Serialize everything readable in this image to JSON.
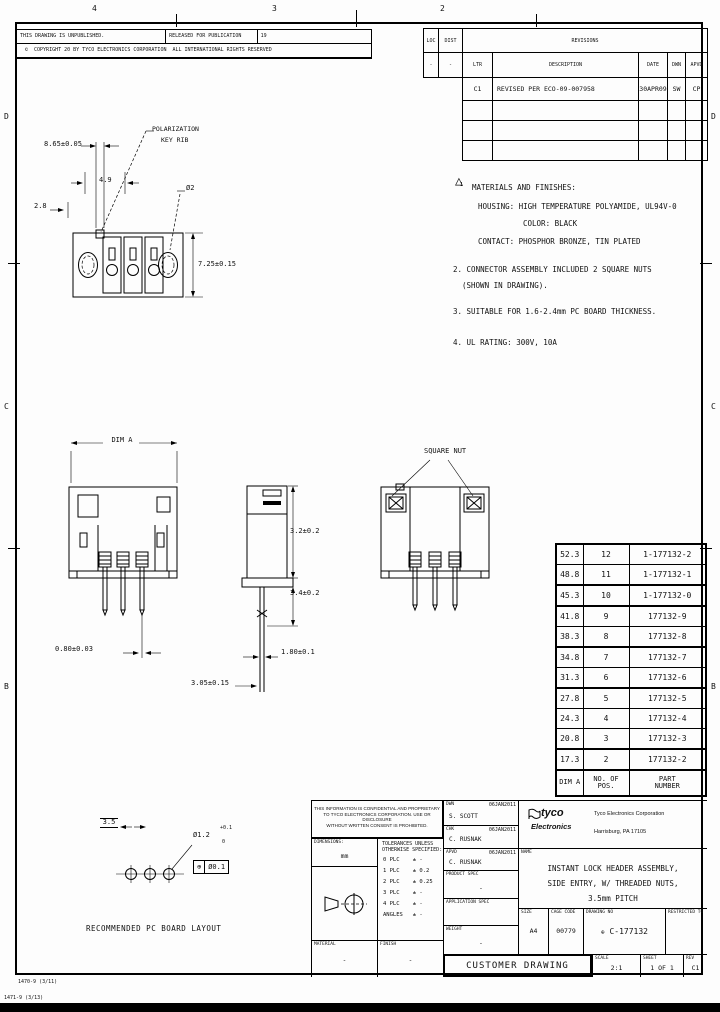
{
  "sheet": {
    "zones_top": [
      "4",
      "3",
      "2"
    ],
    "zones_left": [
      "D",
      "C",
      "B"
    ],
    "zones_right": [
      "D",
      "C",
      "B"
    ],
    "form_no_inner": "1470-9 (3/11)",
    "form_no_outer": "1471-9 (3/13)"
  },
  "header": {
    "unpublished": "THIS DRAWING IS UNPUBLISHED.",
    "released": "RELEASED FOR PUBLICATION",
    "released_date": "19",
    "copyright_symbol": "©",
    "copyright_text": "COPYRIGHT 20      BY TYCO ELECTRONICS CORPORATION",
    "rights_text": "ALL INTERNATIONAL RIGHTS RESERVED"
  },
  "revisions": {
    "loc_label": "LOC",
    "dist_label": "DIST",
    "loc_value": "-",
    "dist_value": "-",
    "title": "REVISIONS",
    "col_ltr": "LTR",
    "col_description": "DESCRIPTION",
    "col_date": "DATE",
    "col_dwn": "DWN",
    "col_apvd": "APVD",
    "rows": [
      {
        "ltr": "C1",
        "description": "REVISED PER ECO-09-007958",
        "date": "30APR09",
        "dwn": "SW",
        "apvd": "CP"
      }
    ]
  },
  "notes": {
    "flag1": "△",
    "flag1_num": "1",
    "n1": "MATERIALS AND FINISHES:",
    "n1a": "HOUSING: HIGH TEMPERATURE POLYAMIDE, UL94V-0",
    "n1b": "COLOR: BLACK",
    "n1c": "CONTACT: PHOSPHOR BRONZE, TIN PLATED",
    "n2": "2. CONNECTOR ASSEMBLY INCLUDED 2 SQUARE NUTS",
    "n2a": "(SHOWN IN DRAWING).",
    "n3": "3. SUITABLE FOR 1.6-2.4mm PC BOARD THICKNESS.",
    "n4": "4. UL RATING: 300V, 10A"
  },
  "part_table": {
    "headers": [
      "DIM A",
      "NO. OF\nPOS.",
      "PART\nNUMBER"
    ],
    "rows": [
      [
        "52.3",
        "12",
        "1-177132-2"
      ],
      [
        "48.8",
        "11",
        "1-177132-1"
      ],
      [
        "45.3",
        "10",
        "1-177132-0"
      ],
      [
        "41.8",
        "9",
        "177132-9"
      ],
      [
        "38.3",
        "8",
        "177132-8"
      ],
      [
        "34.8",
        "7",
        "177132-7"
      ],
      [
        "31.3",
        "6",
        "177132-6"
      ],
      [
        "27.8",
        "5",
        "177132-5"
      ],
      [
        "24.3",
        "4",
        "177132-4"
      ],
      [
        "20.8",
        "3",
        "177132-3"
      ],
      [
        "17.3",
        "2",
        "177132-2"
      ]
    ]
  },
  "dims": {
    "top_width": "8.65±0.05",
    "top_inner": "4.9",
    "top_side": "2.8",
    "polar1": "POLARIZATION",
    "polar2": "KEY RIB",
    "hole": "Ø2",
    "top_height": "7.25±0.15",
    "dim_a": "DIM A",
    "pin_sq": "0.80±0.03",
    "side_a": "3.2±0.2",
    "side_b": "3.4±0.2",
    "pin_w": "1.80±0.1",
    "pin_len": "3.05±0.15",
    "square_nut": "SQUARE NUT",
    "pcb_pitch": "3.5",
    "pcb_hole": "Ø1.2",
    "pcb_tol_plus": "+0.1",
    "pcb_tol_minus": "0",
    "gdt_symbol": "⊕",
    "gdt_value": "Ø0.1",
    "pcb_caption": "RECOMMENDED PC BOARD LAYOUT"
  },
  "titleblock": {
    "legal_1": "THIS INFORMATION IS CONFIDENTIAL AND PROPRIETARY",
    "legal_2": "TO TYCO ELECTRONICS CORPORATION. USE OR DISCLOSURE",
    "legal_3": "WITHOUT WRITTEN CONSENT IS PROHIBITED.",
    "dimensions_label": "DIMENSIONS:",
    "dimensions_unit": "mm",
    "tol_header_1": "TOLERANCES UNLESS",
    "tol_header_2": "OTHERWISE SPECIFIED:",
    "tol_rows": [
      "0 PLC    ± -",
      "1 PLC    ± 0.2",
      "2 PLC    ± 0.25",
      "3 PLC    ± -",
      "4 PLC    ± -",
      "ANGLES   ± -"
    ],
    "material_label": "MATERIAL",
    "material_value": "-",
    "finish_label": "FINISH",
    "finish_value": "-",
    "dwn_label": "DWN",
    "dwn_date": "06JAN2011",
    "dwn_name": "S. SCOTT",
    "chk_label": "CHK",
    "chk_date": "06JAN2011",
    "chk_name": "C. RUSNAK",
    "apvd_label": "APVD",
    "apvd_date": "06JAN2011",
    "apvd_name": "C. RUSNAK",
    "product_spec_label": "PRODUCT SPEC",
    "product_spec_value": "-",
    "application_spec_label": "APPLICATION SPEC",
    "application_spec_value": "",
    "weight_label": "WEIGHT",
    "weight_value": "-",
    "logo_tyco": "tyco",
    "logo_electronics": "Electronics",
    "company_line1": "Tyco Electronics Corporation",
    "company_line2": "Harrisburg, PA 17105",
    "name_label": "NAME",
    "title_line1": "INSTANT LOCK HEADER ASSEMBLY,",
    "title_line2": "SIDE ENTRY, W/ THREADED NUTS,",
    "title_line3": "3.5mm PITCH",
    "size_label": "SIZE",
    "size_value": "A4",
    "cage_label": "CAGE CODE",
    "cage_value": "00779",
    "drawing_no_label": "DRAWING NO",
    "drawing_no_symbol": "⊕",
    "drawing_no_value": "C-177132",
    "restricted_label": "RESTRICTED TO",
    "customer_drawing": "CUSTOMER DRAWING",
    "scale_label": "SCALE",
    "scale_value": "2:1",
    "sheet_label": "SHEET",
    "sheet_value": "1 OF 1",
    "rev_label": "REV",
    "rev_value": "C1"
  }
}
